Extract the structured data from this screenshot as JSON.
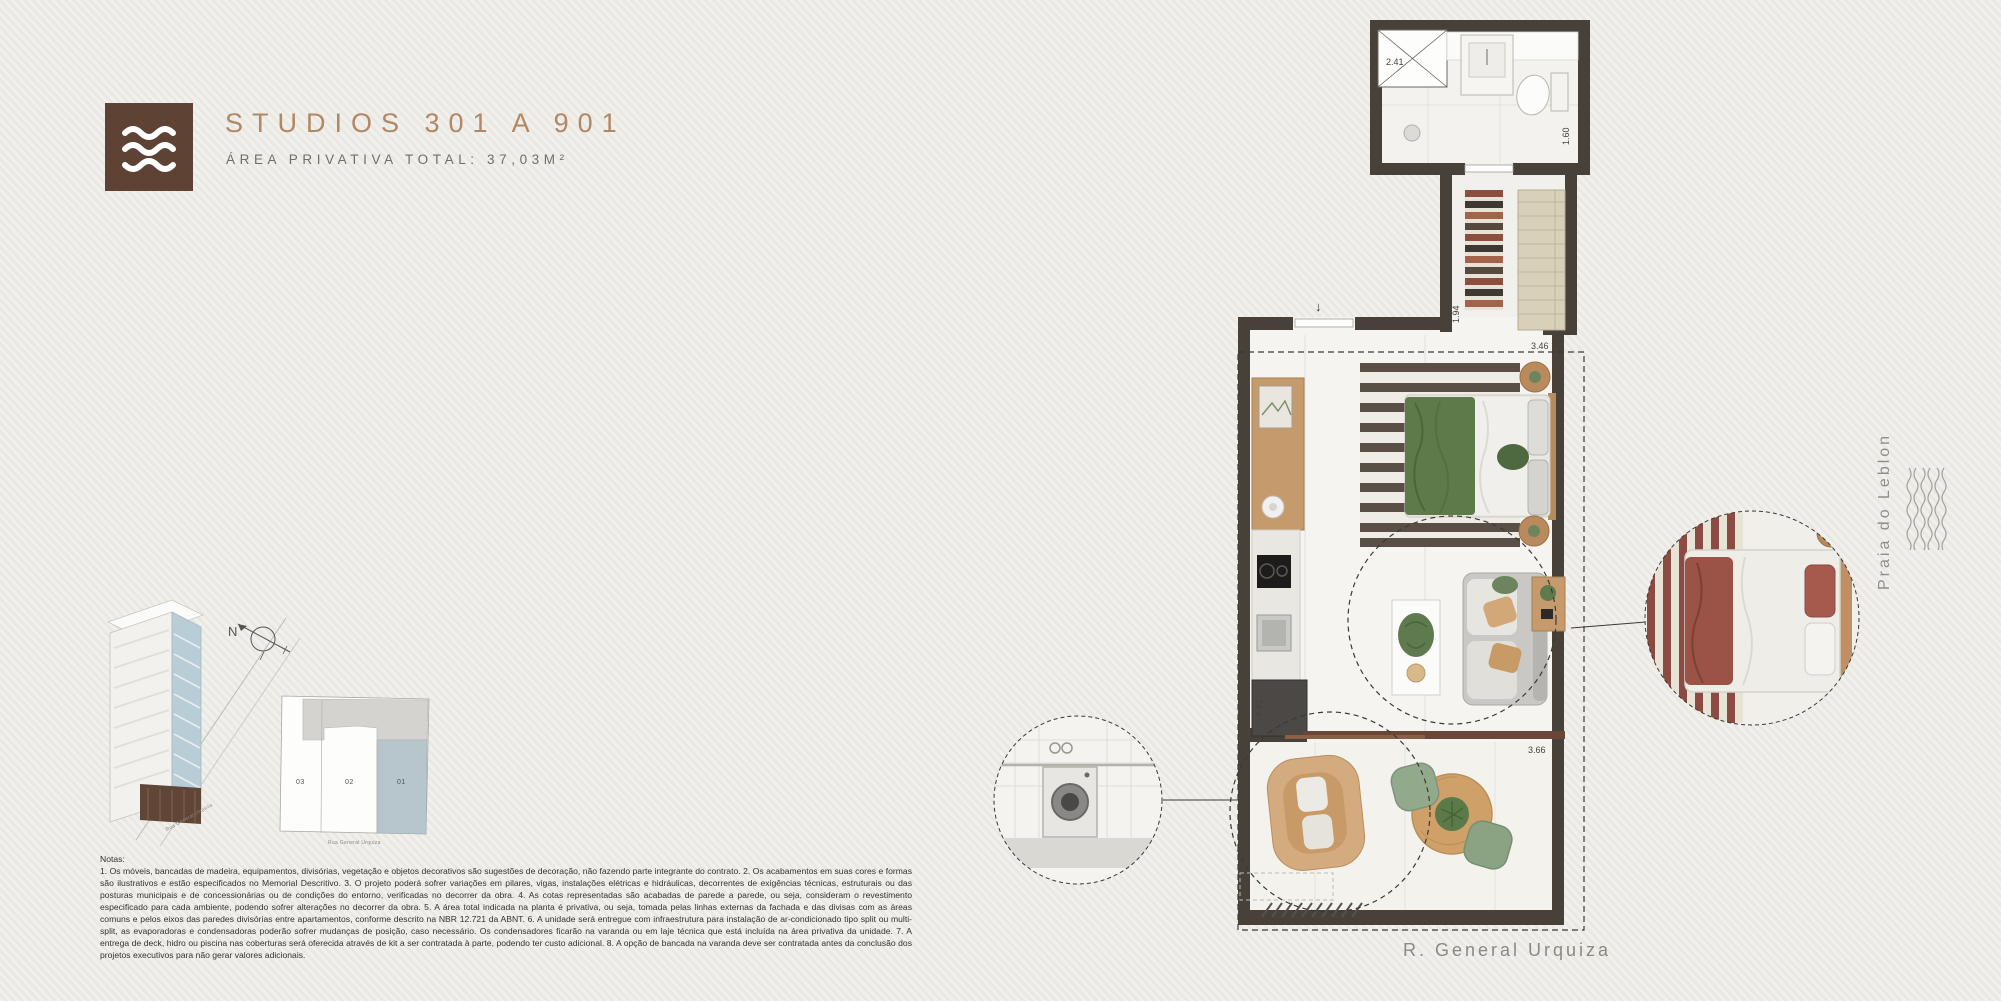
{
  "header": {
    "title": "STUDIOS 301 A 901",
    "subtitle": "ÁREA PRIVATIVA TOTAL: 37,03M²",
    "logo_icon": "waves-icon"
  },
  "key_plan": {
    "compass_label": "N",
    "units": [
      {
        "label": "03",
        "highlighted": false
      },
      {
        "label": "02",
        "highlighted": false
      },
      {
        "label": "01",
        "highlighted": true
      }
    ],
    "street_label": "Rua General Urquiza",
    "building_street_label": "Rua General Urquiza",
    "highlight_color": "#b7c6cd"
  },
  "floor_plan": {
    "entry_arrow": "↓",
    "dimensions": {
      "bath_width": "2.41",
      "bath_depth": "1.60",
      "hall_depth": "1.94",
      "bedroom_width": "3.46",
      "kitchen_depth": "4.41",
      "balcony_width": "3.66"
    },
    "street_label": "R. General Urquiza",
    "detail_bubbles": [
      "kitchen-washer-detail",
      "sofa-bed-detail"
    ]
  },
  "location": {
    "label": "Praia do Leblon",
    "icon": "waves-pattern-icon"
  },
  "notes": {
    "heading": "Notas:",
    "body": "1. Os móveis, bancadas de madeira, equipamentos, divisórias, vegetação e objetos decorativos são sugestões de decoração, não fazendo parte integrante do contrato. 2. Os acabamentos em suas cores e formas são ilustrativos e estão especificados no Memorial Descritivo. 3. O projeto poderá sofrer variações em pilares, vigas, instalações elétricas e hidráulicas, decorrentes de exigências técnicas, estruturais ou das posturas municipais e de concessionárias ou de condições do entorno, verificadas no decorrer da obra. 4. As cotas representadas são acabadas de parede a parede, ou seja, consideram o revestimento especificado para cada ambiente, podendo sofrer alterações no decorrer da obra. 5. A área total indicada na planta é privativa, ou seja, tomada pelas linhas externas da fachada e das divisas com as áreas comuns e pelos eixos das paredes divisórias entre apartamentos, conforme descrito na NBR 12.721 da ABNT. 6. A unidade será entregue com infraestrutura para instalação de ar-condicionado tipo split ou multi-split, as evaporadoras e condensadoras poderão sofrer mudanças de posição, caso necessário. Os condensadores ficarão na varanda ou em laje técnica que está incluída na área privativa da unidade. 7. A entrega de deck, hidro ou piscina nas coberturas será oferecida através de kit a ser contratada à parte, podendo ter custo adicional. 8. A opção de bancada na varanda deve ser contratada antes da conclusão dos projetos executivos para não gerar valores adicionais."
  },
  "colors": {
    "background": "#edebe5",
    "brand_brown": "#5e4234",
    "title_bronze": "#b28763",
    "wall_dark": "#474139",
    "unit_highlight": "#b7c6cd",
    "bed_green": "#5e7a4b",
    "wood": "#c59a6d",
    "rug_rust": "#a5624a",
    "sofa_bed_maroon": "#8c4b42"
  }
}
